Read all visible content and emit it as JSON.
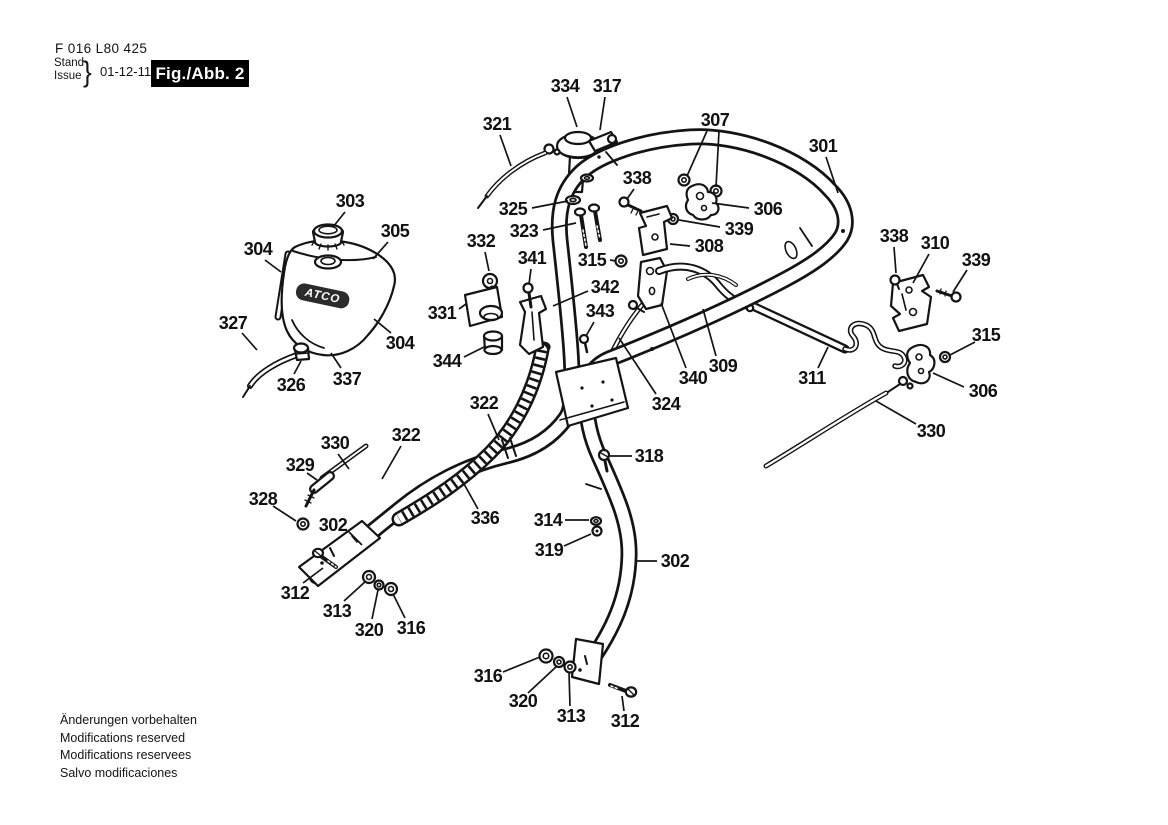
{
  "header": {
    "part_code": "F 016 L80 425",
    "stand_label": "Stand",
    "issue_label": "Issue",
    "brace": "}",
    "date": "01-12-11",
    "figure_label": "Fig./Abb. 2"
  },
  "footer": {
    "lines": [
      "Änderungen vorbehalten",
      "Modifications reserved",
      "Modifications reservees",
      "Salvo modificaciones"
    ]
  },
  "diagram": {
    "tank_logo": "ATCO",
    "callouts": [
      {
        "n": "334",
        "x": 565,
        "y": 86,
        "leaders": [
          [
            567,
            97,
            577,
            127
          ]
        ]
      },
      {
        "n": "317",
        "x": 607,
        "y": 86,
        "leaders": [
          [
            605,
            97,
            600,
            130
          ]
        ]
      },
      {
        "n": "321",
        "x": 497,
        "y": 124,
        "leaders": [
          [
            500,
            135,
            511,
            166
          ]
        ]
      },
      {
        "n": "307",
        "x": 715,
        "y": 120,
        "leaders": [
          [
            707,
            131,
            687,
            176
          ],
          [
            719,
            131,
            716,
            187
          ]
        ]
      },
      {
        "n": "301",
        "x": 823,
        "y": 146,
        "leaders": [
          [
            826,
            157,
            838,
            193
          ]
        ]
      },
      {
        "n": "338",
        "x": 637,
        "y": 178,
        "leaders": [
          [
            634,
            189,
            627,
            199
          ]
        ]
      },
      {
        "n": "325",
        "x": 513,
        "y": 209,
        "leaders": [
          [
            532,
            208,
            568,
            201
          ]
        ]
      },
      {
        "n": "323",
        "x": 524,
        "y": 231,
        "leaders": [
          [
            543,
            230,
            576,
            223
          ]
        ]
      },
      {
        "n": "306",
        "x": 768,
        "y": 209,
        "leaders": [
          [
            749,
            208,
            712,
            203
          ]
        ]
      },
      {
        "n": "339",
        "x": 739,
        "y": 229,
        "leaders": [
          [
            720,
            227,
            679,
            220
          ]
        ]
      },
      {
        "n": "308",
        "x": 709,
        "y": 246,
        "leaders": [
          [
            690,
            246,
            670,
            244
          ]
        ]
      },
      {
        "n": "303",
        "x": 350,
        "y": 201,
        "leaders": [
          [
            345,
            212,
            333,
            227
          ]
        ]
      },
      {
        "n": "305",
        "x": 395,
        "y": 231,
        "leaders": [
          [
            388,
            242,
            373,
            259
          ]
        ]
      },
      {
        "n": "304",
        "x": 258,
        "y": 249,
        "leaders": [
          [
            265,
            260,
            281,
            272
          ]
        ]
      },
      {
        "n": "332",
        "x": 481,
        "y": 241,
        "leaders": [
          [
            485,
            252,
            489,
            271
          ]
        ]
      },
      {
        "n": "341",
        "x": 532,
        "y": 258,
        "leaders": [
          [
            531,
            269,
            529,
            284
          ]
        ]
      },
      {
        "n": "315",
        "x": 592,
        "y": 260,
        "leaders": [
          [
            610,
            260,
            616,
            261
          ]
        ]
      },
      {
        "n": "342",
        "x": 605,
        "y": 287,
        "leaders": [
          [
            588,
            291,
            553,
            306
          ]
        ]
      },
      {
        "n": "343",
        "x": 600,
        "y": 311,
        "leaders": [
          [
            594,
            322,
            586,
            336
          ]
        ]
      },
      {
        "n": "331",
        "x": 442,
        "y": 313,
        "leaders": [
          [
            459,
            309,
            466,
            304
          ]
        ]
      },
      {
        "n": "327",
        "x": 233,
        "y": 323,
        "leaders": [
          [
            242,
            333,
            257,
            350
          ]
        ]
      },
      {
        "n": "344",
        "x": 447,
        "y": 361,
        "leaders": [
          [
            464,
            357,
            484,
            347
          ]
        ]
      },
      {
        "n": "304",
        "x": 400,
        "y": 343,
        "leaders": [
          [
            391,
            333,
            374,
            319
          ]
        ]
      },
      {
        "n": "326",
        "x": 291,
        "y": 385,
        "leaders": [
          [
            294,
            374,
            301,
            361
          ]
        ]
      },
      {
        "n": "337",
        "x": 347,
        "y": 379,
        "leaders": [
          [
            341,
            368,
            331,
            353
          ]
        ]
      },
      {
        "n": "309",
        "x": 723,
        "y": 366,
        "leaders": [
          [
            716,
            356,
            703,
            309
          ]
        ]
      },
      {
        "n": "340",
        "x": 693,
        "y": 378,
        "leaders": [
          [
            686,
            368,
            661,
            303
          ]
        ]
      },
      {
        "n": "324",
        "x": 666,
        "y": 404,
        "leaders": [
          [
            656,
            394,
            619,
            338
          ]
        ]
      },
      {
        "n": "311",
        "x": 812,
        "y": 378,
        "leaders": [
          [
            818,
            368,
            828,
            347
          ]
        ]
      },
      {
        "n": "338",
        "x": 894,
        "y": 236,
        "leaders": [
          [
            894,
            247,
            896,
            273
          ]
        ]
      },
      {
        "n": "310",
        "x": 935,
        "y": 243,
        "leaders": [
          [
            929,
            254,
            913,
            283
          ]
        ]
      },
      {
        "n": "339",
        "x": 976,
        "y": 260,
        "leaders": [
          [
            967,
            270,
            953,
            292
          ]
        ]
      },
      {
        "n": "315",
        "x": 986,
        "y": 335,
        "leaders": [
          [
            975,
            342,
            950,
            355
          ]
        ]
      },
      {
        "n": "306",
        "x": 983,
        "y": 391,
        "leaders": [
          [
            964,
            387,
            933,
            373
          ]
        ]
      },
      {
        "n": "330",
        "x": 931,
        "y": 431,
        "leaders": [
          [
            916,
            424,
            876,
            401
          ]
        ]
      },
      {
        "n": "322",
        "x": 484,
        "y": 403,
        "leaders": [
          [
            488,
            414,
            499,
            440
          ]
        ]
      },
      {
        "n": "330",
        "x": 335,
        "y": 443,
        "leaders": [
          [
            338,
            454,
            349,
            469
          ]
        ]
      },
      {
        "n": "329",
        "x": 300,
        "y": 465,
        "leaders": [
          [
            307,
            473,
            317,
            480
          ]
        ]
      },
      {
        "n": "328",
        "x": 263,
        "y": 499,
        "leaders": [
          [
            273,
            506,
            296,
            521
          ]
        ]
      },
      {
        "n": "302",
        "x": 333,
        "y": 525,
        "leaders": [
          [
            349,
            532,
            362,
            545
          ]
        ]
      },
      {
        "n": "322",
        "x": 406,
        "y": 435,
        "leaders": [
          [
            401,
            446,
            382,
            479
          ]
        ]
      },
      {
        "n": "336",
        "x": 485,
        "y": 518,
        "leaders": [
          [
            478,
            509,
            464,
            484
          ]
        ]
      },
      {
        "n": "312",
        "x": 295,
        "y": 593,
        "leaders": [
          [
            303,
            583,
            323,
            568
          ]
        ]
      },
      {
        "n": "313",
        "x": 337,
        "y": 611,
        "leaders": [
          [
            344,
            601,
            366,
            581
          ]
        ]
      },
      {
        "n": "320",
        "x": 369,
        "y": 630,
        "leaders": [
          [
            372,
            619,
            378,
            590
          ]
        ]
      },
      {
        "n": "316",
        "x": 411,
        "y": 628,
        "leaders": [
          [
            405,
            618,
            393,
            594
          ]
        ]
      },
      {
        "n": "318",
        "x": 649,
        "y": 456,
        "leaders": [
          [
            632,
            456,
            610,
            456
          ]
        ]
      },
      {
        "n": "314",
        "x": 548,
        "y": 520,
        "leaders": [
          [
            565,
            520,
            589,
            520
          ]
        ]
      },
      {
        "n": "319",
        "x": 549,
        "y": 550,
        "leaders": [
          [
            564,
            546,
            591,
            534
          ]
        ]
      },
      {
        "n": "302",
        "x": 675,
        "y": 561,
        "leaders": [
          [
            657,
            561,
            637,
            561
          ]
        ]
      },
      {
        "n": "316",
        "x": 488,
        "y": 676,
        "leaders": [
          [
            503,
            672,
            540,
            657
          ]
        ]
      },
      {
        "n": "320",
        "x": 523,
        "y": 701,
        "leaders": [
          [
            528,
            693,
            557,
            666
          ]
        ]
      },
      {
        "n": "313",
        "x": 571,
        "y": 716,
        "leaders": [
          [
            570,
            706,
            569,
            672
          ]
        ]
      },
      {
        "n": "312",
        "x": 625,
        "y": 721,
        "leaders": [
          [
            624,
            711,
            622,
            696
          ]
        ]
      }
    ]
  }
}
